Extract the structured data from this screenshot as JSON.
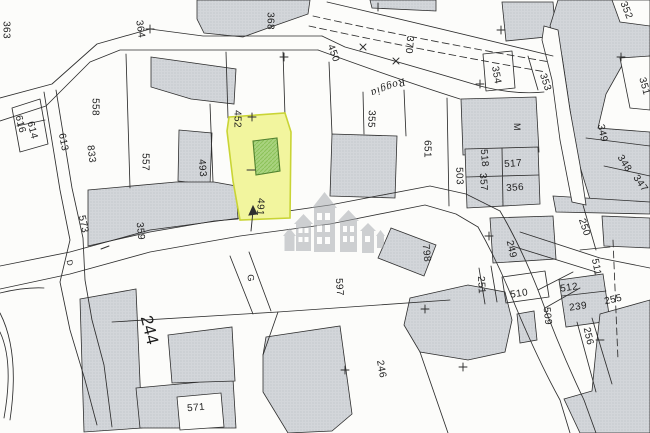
{
  "map": {
    "type": "cadastral-plan",
    "background": "#fcfcfa",
    "line_color": "#2e2e2e",
    "label_color": "#1d1d1d",
    "building_base": "#d3d6da",
    "building_dot": "#b4b8be",
    "watermark_color": "#a8acb0",
    "highlight": {
      "parcel_number": "491",
      "parcel_fill": "#f2f59e",
      "parcel_stroke": "#c9d435",
      "building_fill": "#a9d37f",
      "building_hatch": "#8cc258",
      "building_stroke": "#50812f"
    },
    "street_label": "Roggia",
    "labels": [
      {
        "t": "363",
        "x": 7,
        "y": 30,
        "r": 90
      },
      {
        "t": "364",
        "x": 141,
        "y": 29,
        "r": 82
      },
      {
        "t": "368",
        "x": 271,
        "y": 21,
        "r": 90
      },
      {
        "t": "450",
        "x": 334,
        "y": 53,
        "r": 70
      },
      {
        "t": "370",
        "x": 410,
        "y": 45,
        "r": 95
      },
      {
        "t": "Roggia",
        "x": 388,
        "y": 88,
        "r": 160,
        "f": "serif",
        "s": 11
      },
      {
        "t": "354",
        "x": 497,
        "y": 75,
        "r": 80
      },
      {
        "t": "353",
        "x": 546,
        "y": 82,
        "r": 72
      },
      {
        "t": "352",
        "x": 627,
        "y": 10,
        "r": 68
      },
      {
        "t": "351",
        "x": 645,
        "y": 86,
        "r": 75
      },
      {
        "t": "349",
        "x": 603,
        "y": 133,
        "r": 78
      },
      {
        "t": "348",
        "x": 625,
        "y": 163,
        "r": 58
      },
      {
        "t": "347",
        "x": 641,
        "y": 183,
        "r": 55
      },
      {
        "t": "M",
        "x": 517,
        "y": 127,
        "r": 90,
        "s": 9
      },
      {
        "t": "355",
        "x": 372,
        "y": 119,
        "r": 92
      },
      {
        "t": "651",
        "x": 428,
        "y": 149,
        "r": 90
      },
      {
        "t": "503",
        "x": 460,
        "y": 176,
        "r": 88
      },
      {
        "t": "518",
        "x": 485,
        "y": 158,
        "r": 85
      },
      {
        "t": "517",
        "x": 513,
        "y": 163,
        "r": -4
      },
      {
        "t": "357",
        "x": 484,
        "y": 182,
        "r": 85
      },
      {
        "t": "356",
        "x": 515,
        "y": 187,
        "r": -4
      },
      {
        "t": "452",
        "x": 238,
        "y": 119,
        "r": 90
      },
      {
        "t": "558",
        "x": 96,
        "y": 107,
        "r": 90
      },
      {
        "t": "616",
        "x": 21,
        "y": 124,
        "r": 76
      },
      {
        "t": "614",
        "x": 33,
        "y": 130,
        "r": 76
      },
      {
        "t": "613",
        "x": 64,
        "y": 142,
        "r": 79
      },
      {
        "t": "833",
        "x": 92,
        "y": 154,
        "r": 83
      },
      {
        "t": "557",
        "x": 146,
        "y": 162,
        "r": 90
      },
      {
        "t": "493",
        "x": 203,
        "y": 168,
        "r": 86
      },
      {
        "t": "491",
        "x": 261,
        "y": 207,
        "r": 93
      },
      {
        "t": "573",
        "x": 84,
        "y": 224,
        "r": 78
      },
      {
        "t": "359",
        "x": 141,
        "y": 231,
        "r": 84
      },
      {
        "t": "D",
        "x": 70,
        "y": 263,
        "r": 78,
        "s": 8
      },
      {
        "t": "G",
        "x": 251,
        "y": 278,
        "r": 85,
        "s": 9
      },
      {
        "t": "597",
        "x": 340,
        "y": 287,
        "r": 86
      },
      {
        "t": "798",
        "x": 427,
        "y": 253,
        "r": 84
      },
      {
        "t": "249",
        "x": 512,
        "y": 249,
        "r": 77
      },
      {
        "t": "250",
        "x": 585,
        "y": 227,
        "r": 72
      },
      {
        "t": "251",
        "x": 482,
        "y": 285,
        "r": 87
      },
      {
        "t": "510",
        "x": 519,
        "y": 293,
        "r": -8
      },
      {
        "t": "511",
        "x": 597,
        "y": 267,
        "r": 79
      },
      {
        "t": "512",
        "x": 569,
        "y": 287,
        "r": -8
      },
      {
        "t": "239",
        "x": 578,
        "y": 306,
        "r": -8
      },
      {
        "t": "255",
        "x": 613,
        "y": 299,
        "r": -13
      },
      {
        "t": "509",
        "x": 548,
        "y": 316,
        "r": 84
      },
      {
        "t": "256",
        "x": 589,
        "y": 336,
        "r": 77
      },
      {
        "t": "246",
        "x": 382,
        "y": 369,
        "r": 80
      },
      {
        "t": "244",
        "x": 150,
        "y": 330,
        "r": 76,
        "s": 17
      },
      {
        "t": "571",
        "x": 196,
        "y": 407,
        "r": -5
      }
    ]
  }
}
